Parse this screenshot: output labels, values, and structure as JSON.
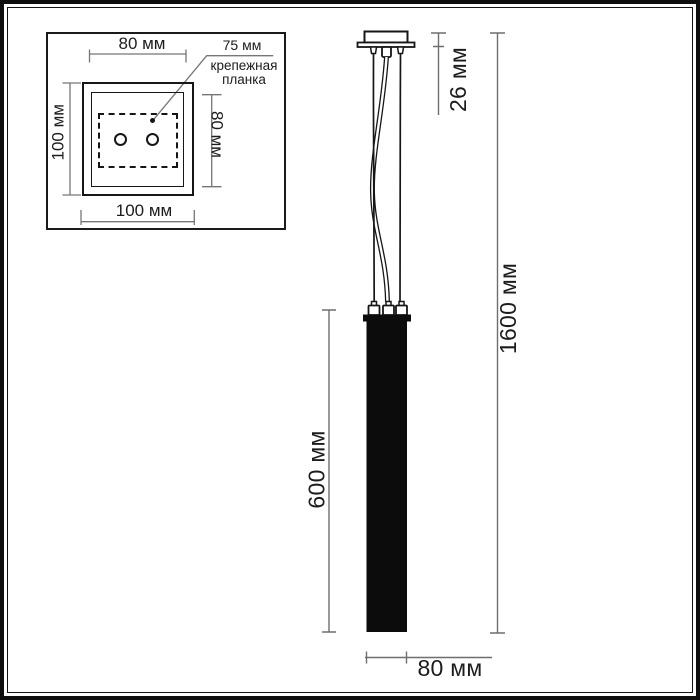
{
  "inset": {
    "dim_top": "80 мм",
    "dim_left": "100 мм",
    "dim_right": "80 мм",
    "dim_bottom": "100 мм",
    "note_value": "75 мм",
    "note_line1": "крепежная",
    "note_line2": "планка"
  },
  "front_view": {
    "dim_canopy_height": "26 мм",
    "dim_total_height": "1600 мм",
    "dim_body_height": "600 мм",
    "dim_body_width": "80 мм"
  },
  "colors": {
    "ink": "#161616",
    "dimension_line": "#6e6e6e",
    "background": "#ffffff"
  }
}
